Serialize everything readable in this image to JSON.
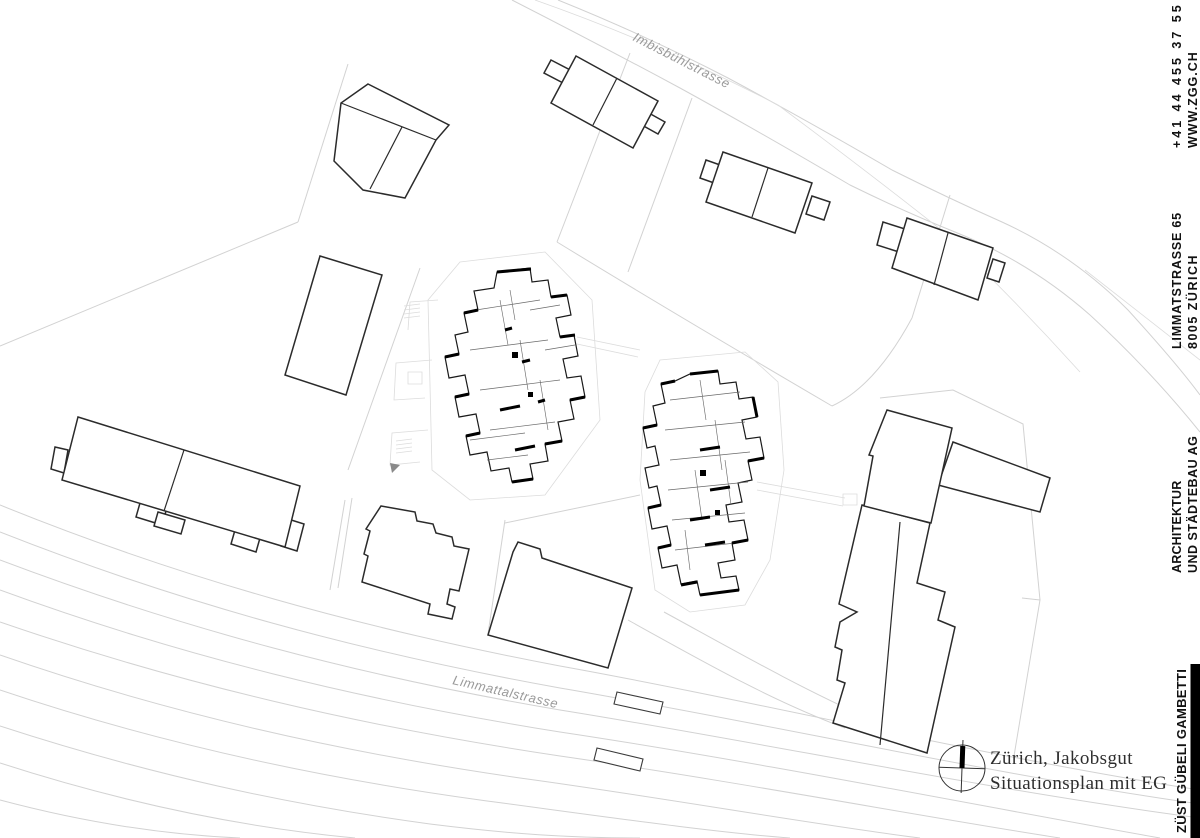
{
  "colors": {
    "background": "#ffffff",
    "light_line": "#d2d2d2",
    "building_line": "#2b2b2b",
    "wall_black": "#000000",
    "street_label_gray": "#9a9a9a",
    "margin_text_black": "#111111",
    "title_text": "#2e2e2e"
  },
  "plan": {
    "street_labels": [
      {
        "text": "Imbisbühlstrasse"
      },
      {
        "text": "Limmattalstrasse"
      }
    ]
  },
  "margin": {
    "contact": {
      "phone": "+41 44 455 37 55",
      "website": "WWW.ZGG.CH"
    },
    "address": {
      "street": "LIMMATSTRASSE 65",
      "city": "8005 ZÜRICH"
    },
    "firm": {
      "line1": "ARCHITEKTUR",
      "line2": "UND STÄDTEBAU AG"
    },
    "brand": "ZÜST GÜBELI GAMBETTI"
  },
  "title_block": {
    "project": "Zürich, Jakobsgut",
    "sheet": "Situationsplan mit EG"
  }
}
